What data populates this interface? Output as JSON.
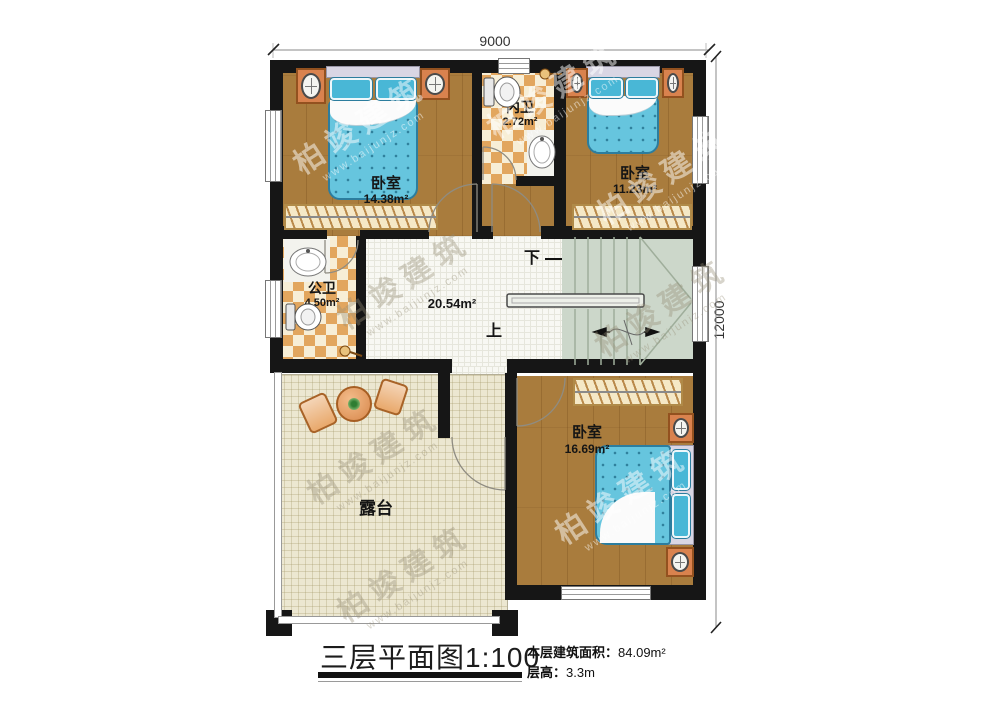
{
  "plan": {
    "dimensions": {
      "width_label": "9000",
      "height_label": "12000"
    },
    "rooms": {
      "bedroom_tl": {
        "name": "卧室",
        "area": "14.38m²"
      },
      "bath_inner": {
        "name": "内卫",
        "area": "2.72m²"
      },
      "bedroom_tr": {
        "name": "卧室",
        "area": "11.23m²"
      },
      "bath_public": {
        "name": "公卫",
        "area": "4.50m²"
      },
      "hall": {
        "area": "20.54m²"
      },
      "bedroom_bottom": {
        "name": "卧室",
        "area": "16.69m²"
      },
      "terrace": {
        "name": "露台"
      }
    },
    "stairs": {
      "down_label": "下",
      "up_label": "上"
    }
  },
  "footer": {
    "title": "三层平面图1:100",
    "info": [
      {
        "label": "本层建筑面积：",
        "value": "84.09m²"
      },
      {
        "label": "层高：",
        "value": "3.3m"
      }
    ]
  },
  "watermark": {
    "brand": "柏竣建筑",
    "url": "www.baijunjz.com"
  },
  "colors": {
    "wall": "#161616",
    "wood_floor": "#a97c3d",
    "tile_light": "#f7eed6",
    "tile_orange": "#e2a65e",
    "hall_tile": "#f8f8f3",
    "terrace_floor": "#ece7d1",
    "stairs": "#ccd7ca",
    "bed": "#66c5de",
    "furniture_orange": "#d9824e"
  }
}
